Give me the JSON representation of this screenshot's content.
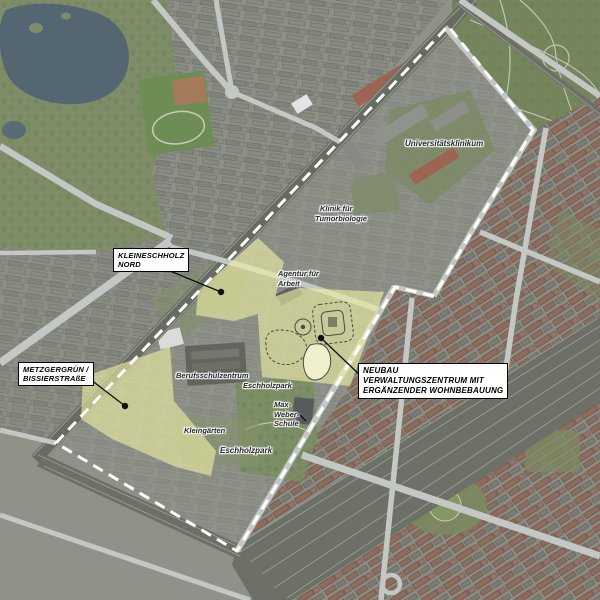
{
  "map": {
    "annotation_boxes": [
      {
        "name": "kleineschholz-nord",
        "lines": [
          "KLEINESCHHOLZ",
          "NORD"
        ]
      },
      {
        "name": "metzgergruen-bissierstrasse",
        "lines": [
          "METZGERGRÜN /",
          "BISSIERSTRAßE"
        ]
      },
      {
        "name": "neubau-verwaltungszentrum",
        "lines": [
          "NEUBAU",
          "VERWALTUNGSZENTRUM MIT",
          "ERGÄNZENDER WOHNBEBAUUNG"
        ]
      }
    ],
    "place_labels": [
      {
        "name": "universitaetsklinikum",
        "lines": [
          "Universitätsklinikum"
        ]
      },
      {
        "name": "klinik-fuer-tumorbiologie",
        "lines": [
          "Klinik für",
          "Tumorbiologie"
        ]
      },
      {
        "name": "agentur-fuer-arbeit",
        "lines": [
          "Agentur für",
          "Arbeit"
        ]
      },
      {
        "name": "berufsschulzentrum",
        "lines": [
          "Berufsschulzentrum"
        ]
      },
      {
        "name": "eschholzpark-north",
        "lines": [
          "Eschholzpark"
        ]
      },
      {
        "name": "max-weber-schule",
        "lines": [
          "Max-",
          "Weber-",
          "Schule"
        ]
      },
      {
        "name": "kleingaerten",
        "lines": [
          "Kleingärten"
        ]
      },
      {
        "name": "eschholzpark-south",
        "lines": [
          "Eschholzpark"
        ]
      }
    ],
    "colors": {
      "highlight_area": "#edefa3",
      "boundary_dash": "#ffffff",
      "annotation_box_bg": "#ffffff",
      "annotation_box_border": "#000000",
      "annotation_text": "#000000",
      "place_label_text": "#26262c",
      "leader": "#101010",
      "lake_water": "#556673",
      "park_green": "#7e8d68"
    }
  }
}
